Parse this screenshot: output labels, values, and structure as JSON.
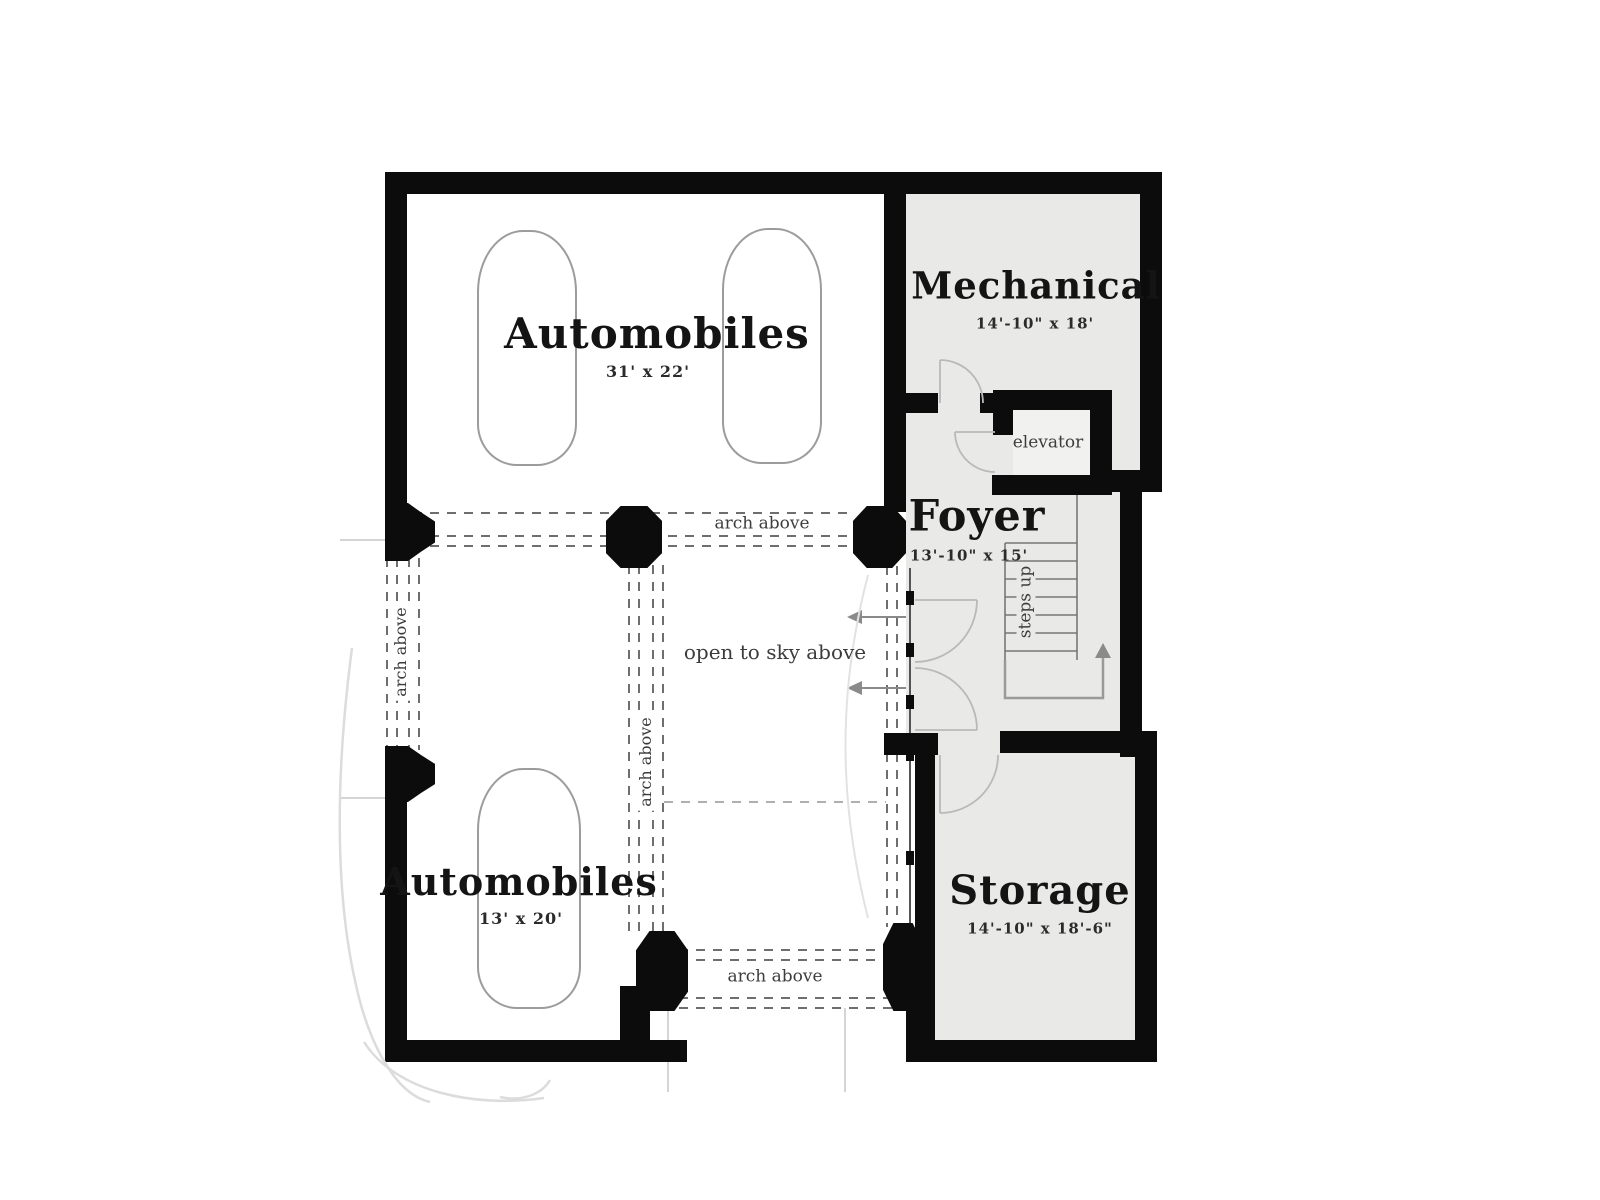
{
  "plan": {
    "title": "Basement garage floor plan",
    "rooms": {
      "garage_upper": {
        "label": "Automobiles",
        "dims": "31' x 22'"
      },
      "mechanical": {
        "label": "Mechanical",
        "dims": "14'-10\" x 18'"
      },
      "foyer": {
        "label": "Foyer",
        "dims": "13'-10\" x 15'"
      },
      "garage_lower": {
        "label": "Automobiles",
        "dims": "13' x 20'"
      },
      "storage": {
        "label": "Storage",
        "dims": "14'-10\" x 18'-6\""
      },
      "elevator": {
        "label": "elevator"
      }
    },
    "annotations": {
      "open_sky": "open to sky above",
      "arch_above": "arch above",
      "steps_up": "steps up"
    },
    "colors": {
      "wall": "#0c0c0c",
      "room_fill": "#e9e9e8",
      "dash_line": "#6e6e6e",
      "thin_line": "#9c9c9c"
    }
  }
}
